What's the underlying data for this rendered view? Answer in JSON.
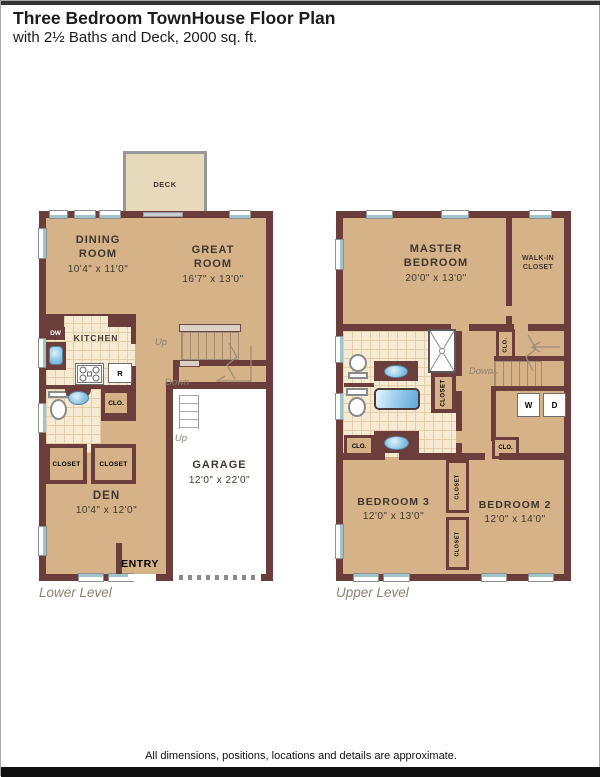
{
  "header": {
    "title": "Three Bedroom TownHouse Floor Plan",
    "subtitle": "with 2½ Baths and Deck, 2000 sq. ft."
  },
  "footer": {
    "note": "All dimensions, positions, locations and details are approximate."
  },
  "colors": {
    "wall": "#6B3E3C",
    "floor": "#D5B287",
    "deck": "#E7D9BC",
    "deckline": "#98989A",
    "tile": "#F6EAD3",
    "tileline": "#E4CDA9",
    "window": "#9FC4CC",
    "ink": "#40362E",
    "muted": "#8D8174",
    "stair": "#9C8C78"
  },
  "lower": {
    "level": "Lower Level",
    "deck": "DECK",
    "dining_name": "DINING\nROOM",
    "dining_dims": "10'4\" x 11'0\"",
    "great_name": "GREAT\nROOM",
    "great_dims": "16'7\" x 13'0\"",
    "kitchen": "KITCHEN",
    "dw": "DW",
    "fridge": "R",
    "clo": "CLO.",
    "closet_a": "CLOSET",
    "closet_b": "CLOSET",
    "den_name": "DEN",
    "den_dims": "10'4\" x 12'0\"",
    "garage_name": "GARAGE",
    "garage_dims": "12'0\" x 22'0\"",
    "entry": "ENTRY",
    "up_main": "Up",
    "down": "Down",
    "up_entry": "Up"
  },
  "upper": {
    "level": "Upper Level",
    "master_name": "MASTER\nBEDROOM",
    "master_dims": "20'0\" x 13'0\"",
    "wic": "WALK-IN\nCLOSET",
    "bath_closet": "CLOSET",
    "stair_clo": "CLO.",
    "down": "Down",
    "washer": "W",
    "dryer": "D",
    "clo_left": "CLO.",
    "clo_right": "CLO.",
    "bed3_name": "BEDROOM 3",
    "bed3_dims": "12'0\" x 13'0\"",
    "bed2_name": "BEDROOM 2",
    "bed2_dims": "12'0\" x 14'0\"",
    "closet_b1": "CLOSET",
    "closet_b2": "CLOSET"
  }
}
